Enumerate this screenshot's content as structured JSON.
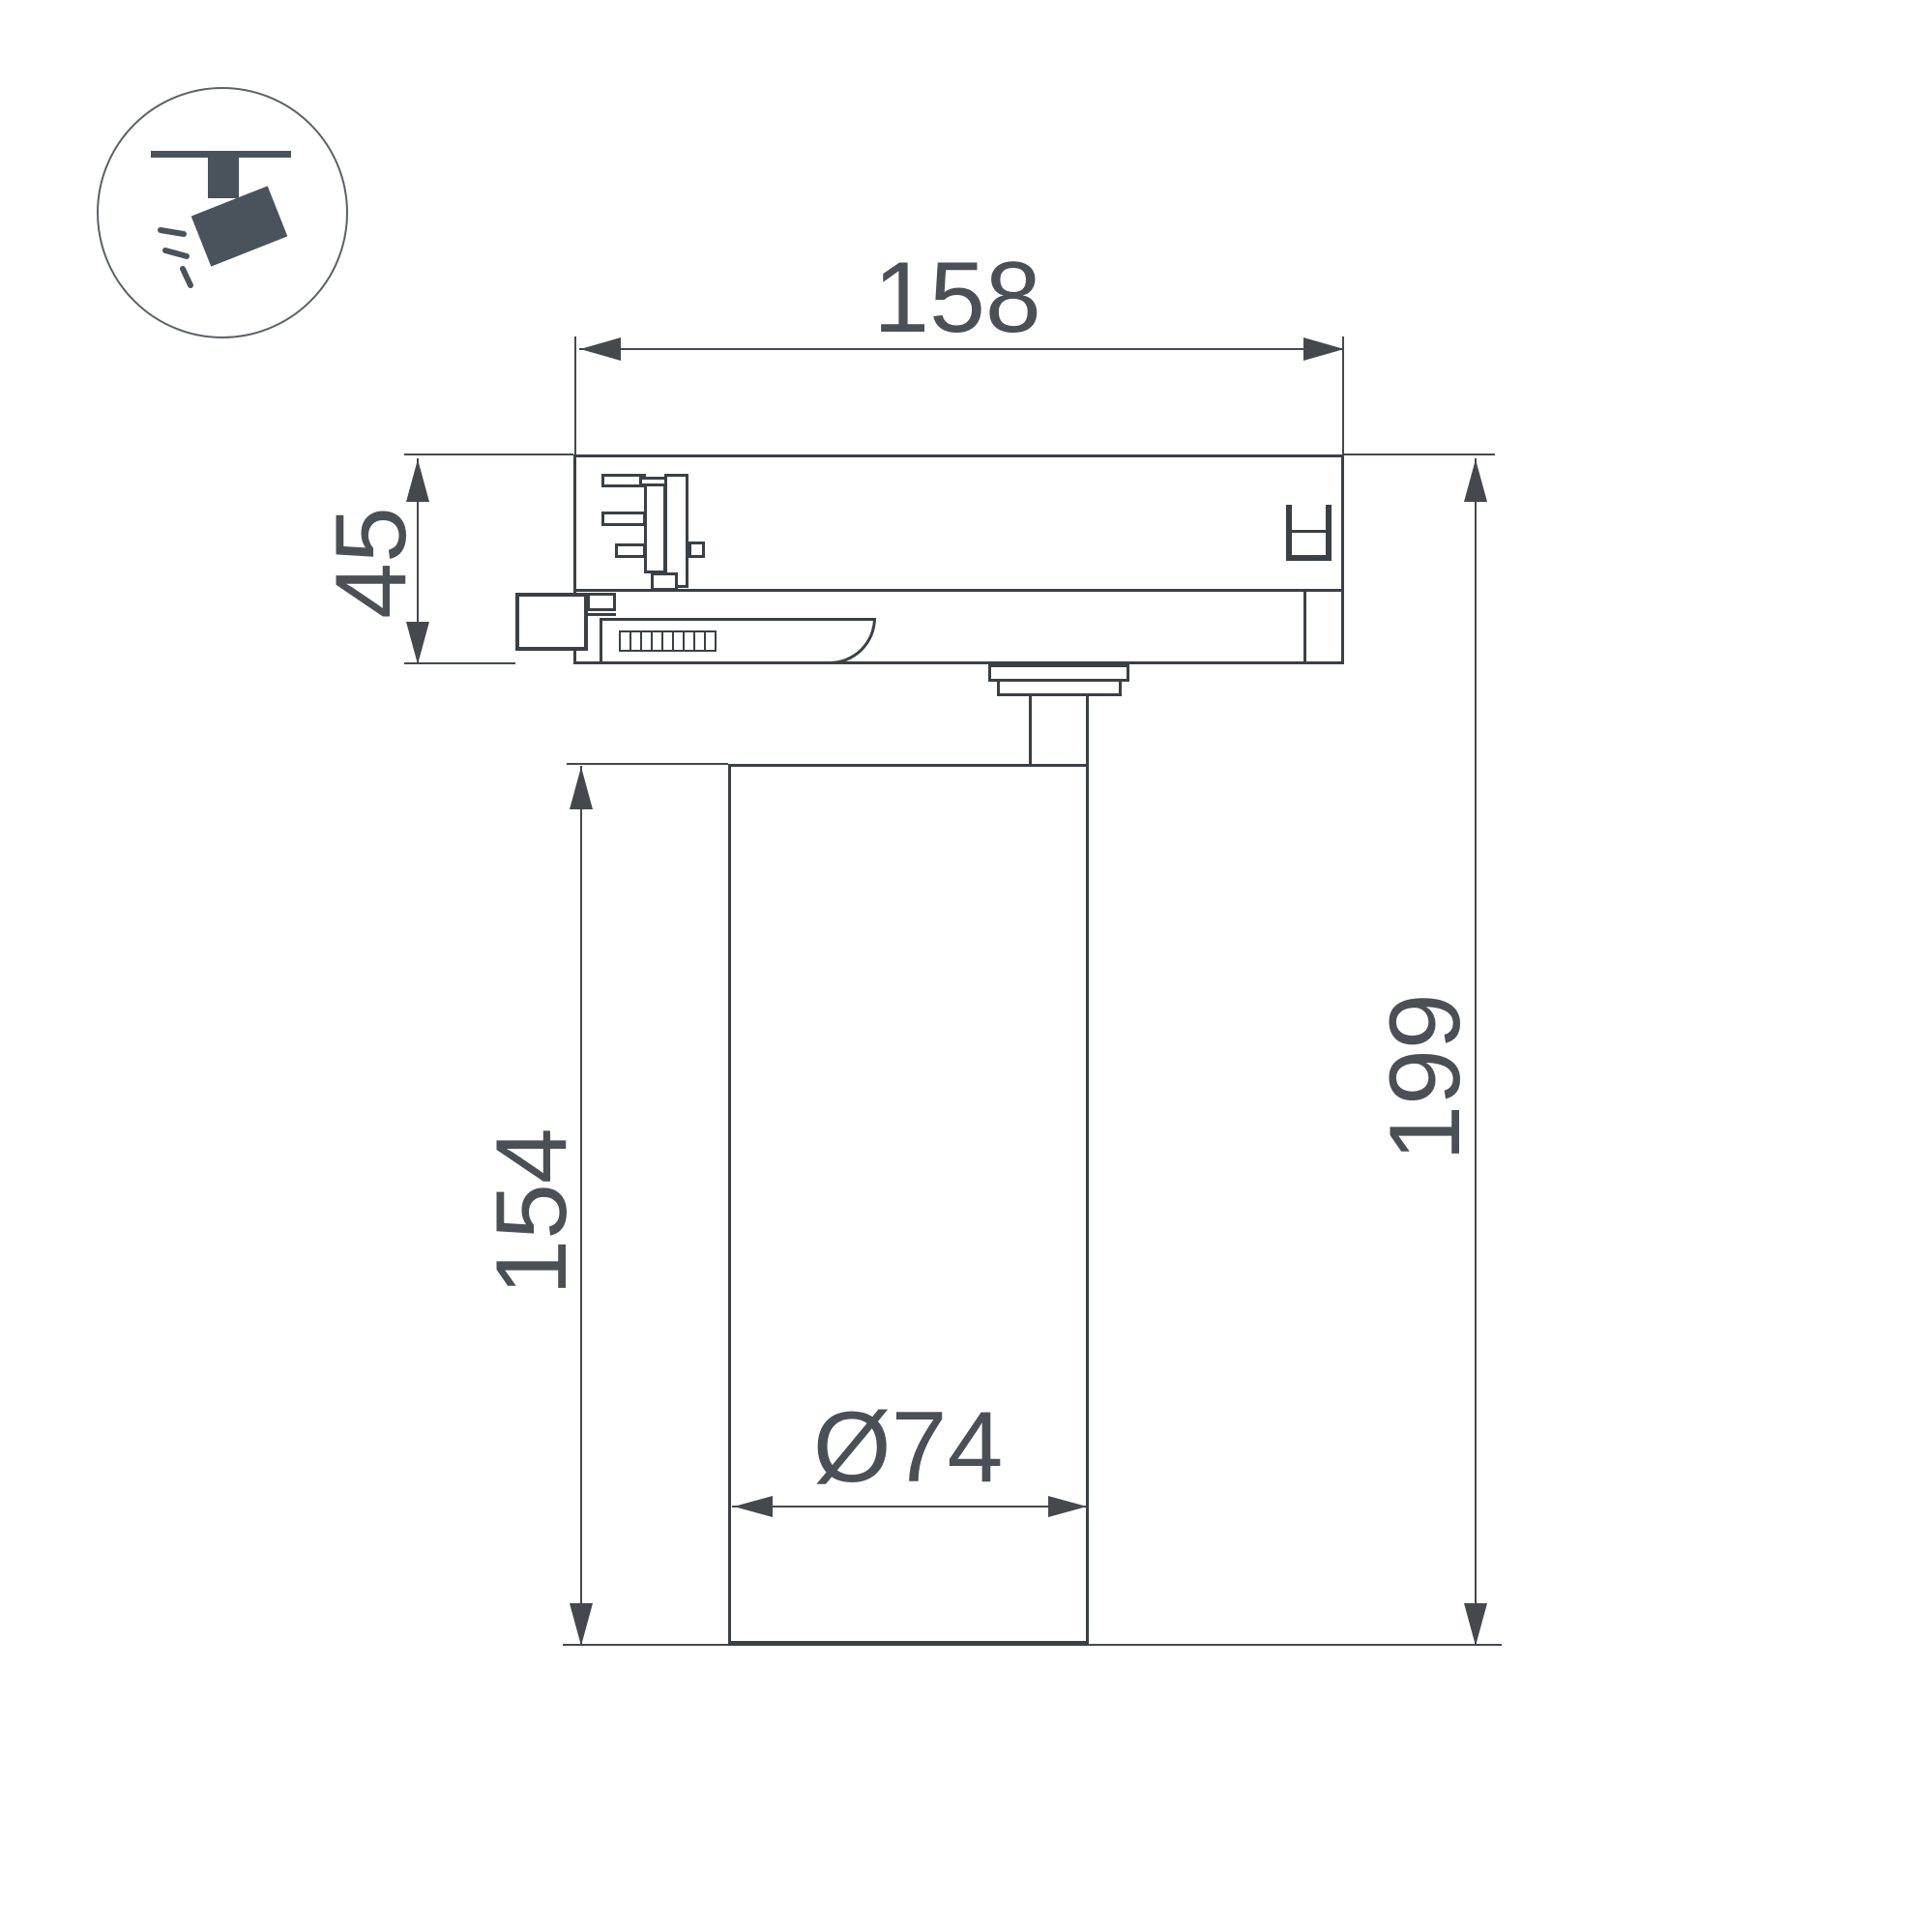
{
  "page": {
    "background": "#ffffff"
  },
  "colors": {
    "object_line": "#3a4046",
    "dimension_line": "#45494e",
    "text": "#4a5055",
    "icon_fill": "#4a535b"
  },
  "icon": {
    "name": "track-spotlight-icon"
  },
  "dimensions": {
    "top_width": "158",
    "adapter_height": "45",
    "body_height": "154",
    "total_height": "199",
    "diameter": "Ø74"
  }
}
